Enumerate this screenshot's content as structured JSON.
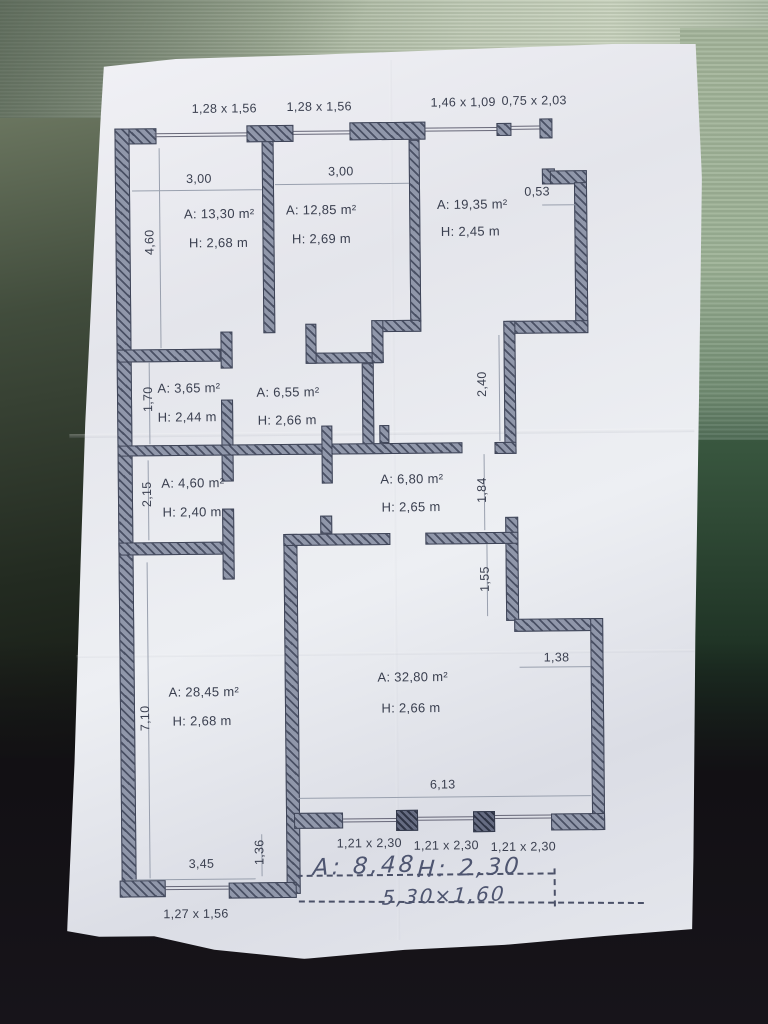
{
  "colors": {
    "wall_fill": "#858ca0",
    "ink": "#3b4050",
    "paper": "#e9ebf0",
    "handwriting_ink": "#4e5570",
    "table_top": "#b0bda7",
    "table_bottom": "#141114"
  },
  "windows_top": [
    "1,28 x 1,56",
    "1,28 x 1,56",
    "1,46 x 1,09",
    "0,75 x 2,03"
  ],
  "rooms": [
    {
      "id": "room-13-30",
      "area": "A: 13,30 m²",
      "height": "H: 2,68 m"
    },
    {
      "id": "room-12-85",
      "area": "A: 12,85 m²",
      "height": "H: 2,69 m"
    },
    {
      "id": "room-19-35",
      "area": "A: 19,35 m²",
      "height": "H: 2,45 m"
    },
    {
      "id": "room-3-65",
      "area": "A: 3,65 m²",
      "height": "H: 2,44 m"
    },
    {
      "id": "room-6-55",
      "area": "A: 6,55 m²",
      "height": "H: 2,66 m"
    },
    {
      "id": "room-4-60",
      "area": "A: 4,60 m²",
      "height": "H: 2,40 m"
    },
    {
      "id": "room-6-80",
      "area": "A: 6,80 m²",
      "height": "H: 2,65 m"
    },
    {
      "id": "room-28-45",
      "area": "A: 28,45 m²",
      "height": "H: 2,68 m"
    },
    {
      "id": "room-32-80",
      "area": "A: 32,80 m²",
      "height": "H: 2,66 m"
    }
  ],
  "dims": {
    "room1_width": "3,00",
    "room2_width": "3,00",
    "room1_height": "4,60",
    "niche_width": "0,53",
    "room4_height": "1,70",
    "hall_length": "2,40",
    "room6_height": "2,15",
    "passage_upper": "1,84",
    "passage_lower": "1,55",
    "step_width": "1,38",
    "room8_height": "7,10",
    "room9_width": "6,13",
    "corner_width": "1,36",
    "room8_width": "3,45"
  },
  "windows_bottom": [
    "1,21 x 2,30",
    "1,21 x 2,30",
    "1,21 x 2,30",
    "1,27 x 1,56"
  ],
  "handwritten": {
    "area": "A: 8,48",
    "height": "H: 2,30",
    "size": "5,30×1,60"
  }
}
